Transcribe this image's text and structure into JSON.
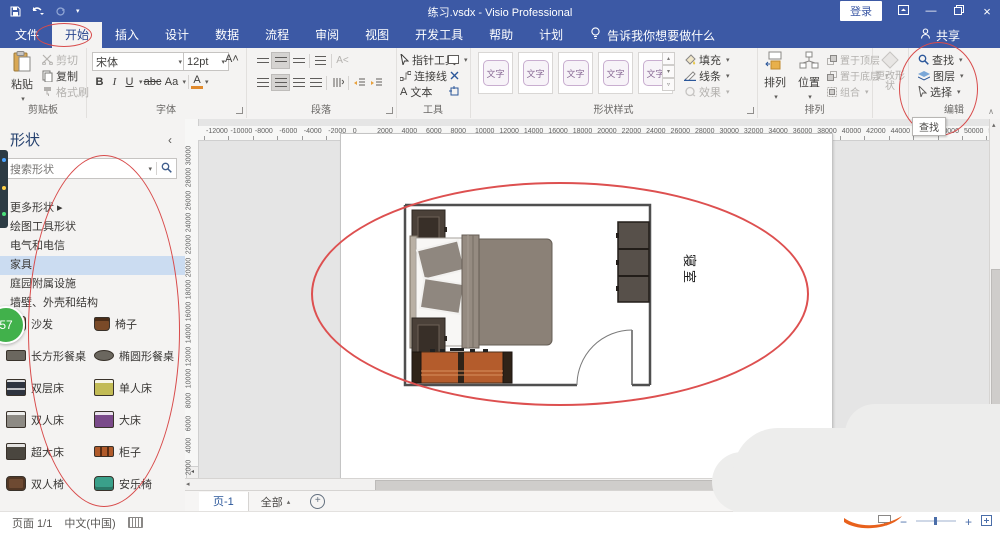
{
  "title_bar": {
    "title": "练习.vsdx - Visio Professional",
    "sign_in": "登录"
  },
  "tabs": {
    "items": [
      "文件",
      "开始",
      "插入",
      "设计",
      "数据",
      "流程",
      "审阅",
      "视图",
      "开发工具",
      "帮助",
      "计划"
    ],
    "active": "开始",
    "tell_me": "告诉我你想要做什么",
    "share": "共享"
  },
  "ribbon": {
    "clipboard": {
      "label": "剪贴板",
      "paste": "粘贴",
      "cut": "剪切",
      "copy": "复制",
      "format_painter": "格式刷"
    },
    "font": {
      "label": "字体",
      "family": "宋体",
      "size": "12pt",
      "bold": "B",
      "italic": "I",
      "underline": "U",
      "strike": "abc",
      "case": "Aa",
      "color": "A"
    },
    "paragraph": {
      "label": "段落"
    },
    "tools": {
      "label": "工具",
      "pointer": "指针工具",
      "connector": "连接线",
      "text_label": "文本",
      "text_a": "A"
    },
    "shape_styles": {
      "label": "形状样式",
      "swatches": [
        "文字",
        "文字",
        "文字",
        "文字",
        "文字"
      ],
      "fill": "填充",
      "line": "线条",
      "effects": "效果"
    },
    "arrange": {
      "label": "排列",
      "align": "排列",
      "position": "位置",
      "bring_front": "置于顶层",
      "send_back": "置于底层",
      "group": "组合"
    },
    "change_shape": "更改形状",
    "editing": {
      "label": "编辑",
      "find": "查找",
      "layers": "图层",
      "select": "选择"
    },
    "find_tooltip": "查找"
  },
  "sidebar": {
    "title": "形状",
    "search_placeholder": "搜索形状",
    "categories": [
      {
        "label": "更多形状",
        "arrow": "▸",
        "selected": false
      },
      {
        "label": "绘图工具形状",
        "arrow": "",
        "selected": false
      },
      {
        "label": "电气和电信",
        "arrow": "",
        "selected": false
      },
      {
        "label": "家具",
        "arrow": "",
        "selected": true
      },
      {
        "label": "庭园附属设施",
        "arrow": "",
        "selected": false
      },
      {
        "label": "墙壁、外壳和结构",
        "arrow": "",
        "selected": false
      }
    ],
    "stencil_items": [
      {
        "label": "沙发",
        "icon": "sofa-icon",
        "color": "#8a4b2e"
      },
      {
        "label": "椅子",
        "icon": "chair-icon",
        "color": "#7a4a28"
      },
      {
        "label": "长方形餐桌",
        "icon": "rect-table-icon",
        "color": "#6b675f"
      },
      {
        "label": "椭圆形餐桌",
        "icon": "oval-table-icon",
        "color": "#6b675f"
      },
      {
        "label": "双层床",
        "icon": "bunk-bed-icon",
        "color": "#2e3440"
      },
      {
        "label": "单人床",
        "icon": "single-bed-icon",
        "color": "#c2bb55"
      },
      {
        "label": "双人床",
        "icon": "double-bed-icon",
        "color": "#8d8a84"
      },
      {
        "label": "大床",
        "icon": "large-bed-icon",
        "color": "#7a4a8a"
      },
      {
        "label": "超大床",
        "icon": "xl-bed-icon",
        "color": "#4a463f"
      },
      {
        "label": "柜子",
        "icon": "cabinet-icon",
        "color": "#b05a2a"
      },
      {
        "label": "双人椅",
        "icon": "loveseat-icon",
        "color": "#6e4a32"
      },
      {
        "label": "安乐椅",
        "icon": "easy-chair-icon",
        "color": "#3aa08a"
      }
    ]
  },
  "overlay": {
    "badge_count": "57"
  },
  "canvas": {
    "room_label": "寝室",
    "h_ruler": [
      -12000,
      -10000,
      -8000,
      -6000,
      -4000,
      -2000,
      0,
      2000,
      4000,
      6000,
      8000,
      10000,
      12000,
      14000,
      16000,
      18000,
      20000,
      22000,
      24000,
      26000,
      28000,
      30000,
      32000,
      34000,
      36000,
      38000,
      40000,
      42000,
      44000,
      46000,
      48000,
      50000,
      52000,
      54000
    ],
    "v_ruler": [
      30000,
      28000,
      26000,
      24000,
      22000,
      20000,
      18000,
      16000,
      14000,
      12000,
      10000,
      8000,
      6000,
      4000,
      2000
    ]
  },
  "page_bar": {
    "page_tab": "页-1",
    "all_pages": "全部"
  },
  "status_bar": {
    "page_indicator": "页面 1/1",
    "language": "中文(中国)"
  },
  "annotation_color": "#d84b4b"
}
